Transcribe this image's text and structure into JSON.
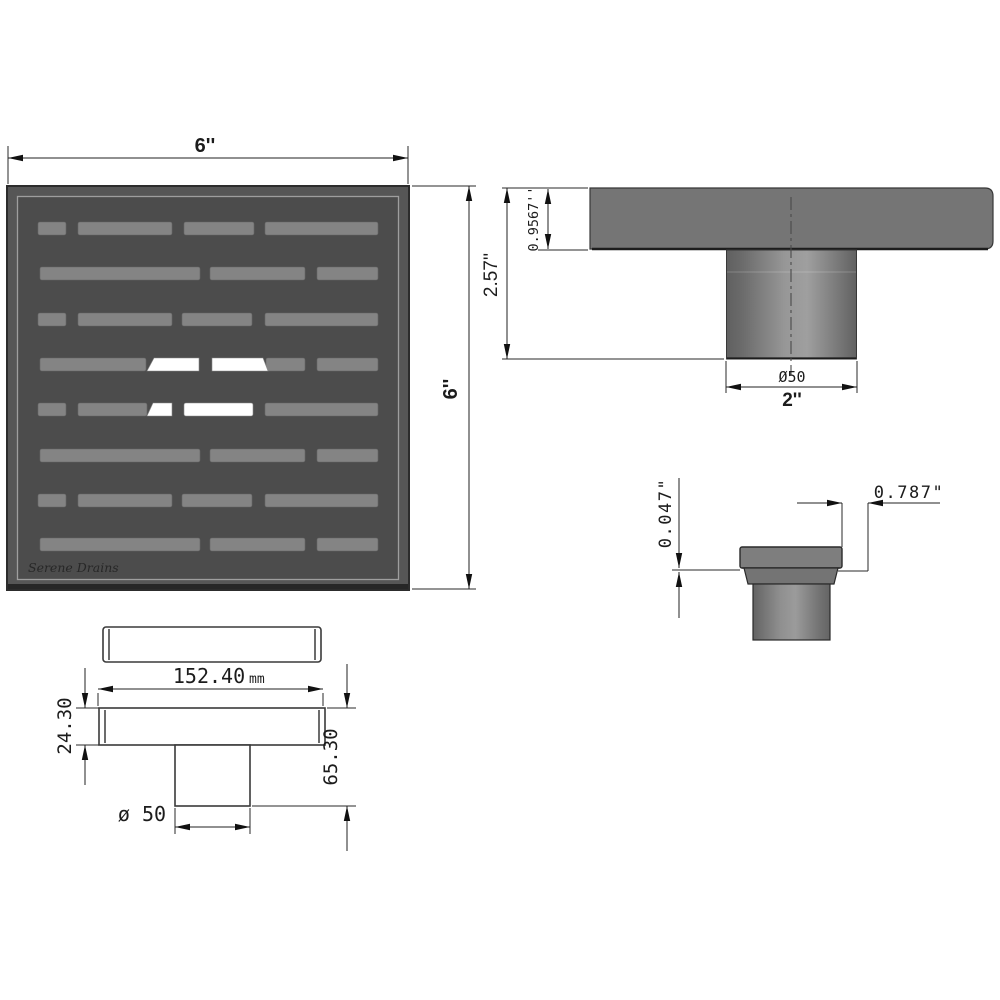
{
  "drawing": {
    "brand_logo": "Serene Drains",
    "top_view": {
      "width_label": "6''",
      "height_label": "6''"
    },
    "side_view": {
      "total_height_label": "2.57''",
      "plate_thickness_label": "0.9567''",
      "outlet_diameter_label": "Ø50",
      "outlet_width_label": "2''"
    },
    "detail_view": {
      "lip_height_label": "0.047\"",
      "edge_offset_label": "0.787\""
    },
    "bottom_view": {
      "length_label": "152.40",
      "length_unit_label": "mm",
      "body_height_label": "24.30",
      "total_height_label": "65.30",
      "pipe_diameter_label": "ø 50"
    },
    "colors": {
      "grate_frame": "#565656",
      "grate_plate": "#4c4c4c",
      "slot": "#848484",
      "open_slot": "#ffffff",
      "side_plate": "#757575",
      "pipe_dark": "#5e5e5e",
      "pipe_light": "#9e9e9e",
      "line": "#222222"
    }
  }
}
